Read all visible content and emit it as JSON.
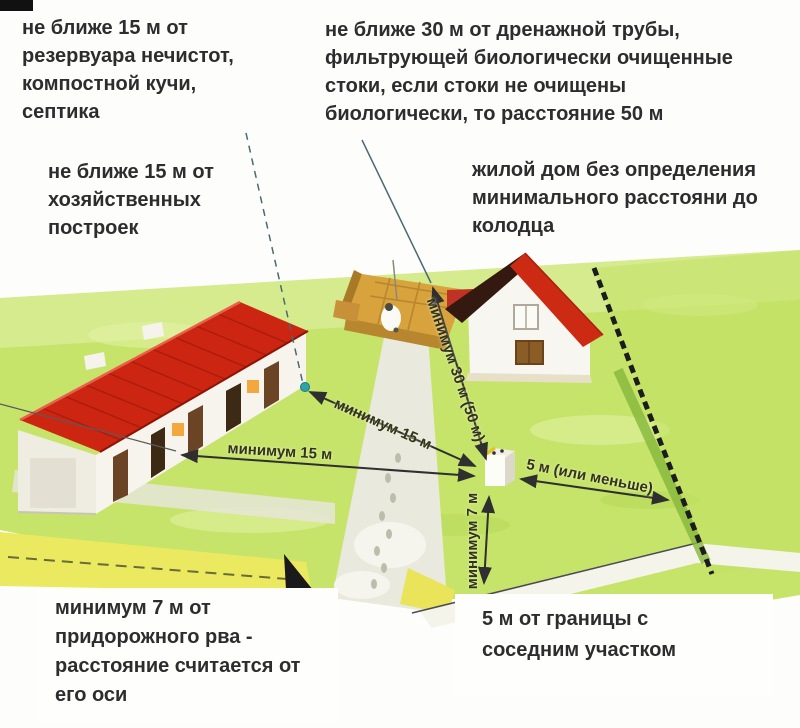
{
  "annotations": {
    "septic": {
      "lines": [
        "не ближе 15 м от",
        "резервуара нечистот,",
        "компостной кучи,",
        "септика"
      ]
    },
    "drainage": {
      "lines": [
        "не ближе 30 м от дренажной трубы,",
        "фильтрующей биологически очищенные",
        "стоки, если стоки не очищены",
        "биологически, то расстояние 50 м"
      ]
    },
    "outbuildings": {
      "lines": [
        "не ближе 15 м от",
        "хозяйственных",
        "построек"
      ]
    },
    "house": {
      "lines": [
        "жилой дом без определения",
        "минимального расстояни до",
        "колодца"
      ]
    },
    "ditch": {
      "lines": [
        "минимум 7 м от",
        "придорожного рва -",
        "расстояние считается от",
        "его оси"
      ]
    },
    "boundary": {
      "lines": [
        "5 м от границы с",
        "соседним участком"
      ]
    }
  },
  "distances": {
    "septic_to_well": "минимум 15 м",
    "outbuildings_to_well": "минимум 15 м",
    "drainage_to_well": "минимум 30 м (50 м)",
    "boundary_to_well": "5 м (или меньше)",
    "ditch_to_well": "минимум 7 м"
  },
  "colors": {
    "lawn": "#c6e36a",
    "lawn_light": "#dcefa0",
    "ditch_yellow": "#ebe95f",
    "roof_red": "#cc2512",
    "roof_dark": "#33190f",
    "wall_white": "#f7f5ef",
    "compost_ochre": "#d8a33c",
    "fence_black": "#1c1c1c",
    "arrow": "#2f2f2f",
    "text": "#2d2d2d",
    "marker_teal": "#2fa3a8"
  }
}
